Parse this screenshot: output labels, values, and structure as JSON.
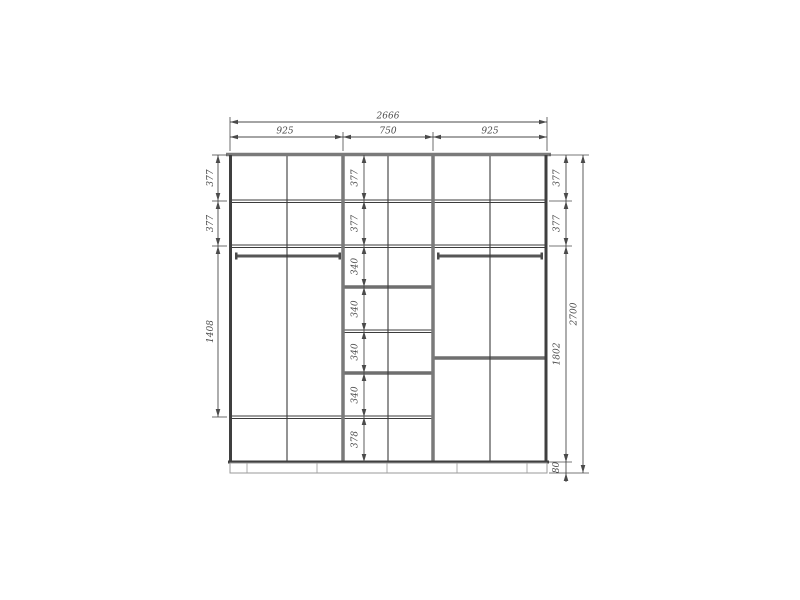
{
  "drawing": {
    "kind": "wardrobe-elevation-technical-drawing",
    "colors": {
      "background": "#ffffff",
      "line": "#3b3b3b",
      "panel": "#7a7a7a",
      "dimension_text": "#4a4a4a"
    },
    "dims": {
      "total_width": "2666",
      "total_height": "2700",
      "top_sections": [
        "925",
        "750",
        "925"
      ],
      "left_chain": [
        "377",
        "377",
        "1408"
      ],
      "center_chain": [
        "377",
        "377",
        "340",
        "340",
        "340",
        "340",
        "378"
      ],
      "right_chain": [
        "377",
        "377",
        "1802",
        "80"
      ]
    }
  }
}
